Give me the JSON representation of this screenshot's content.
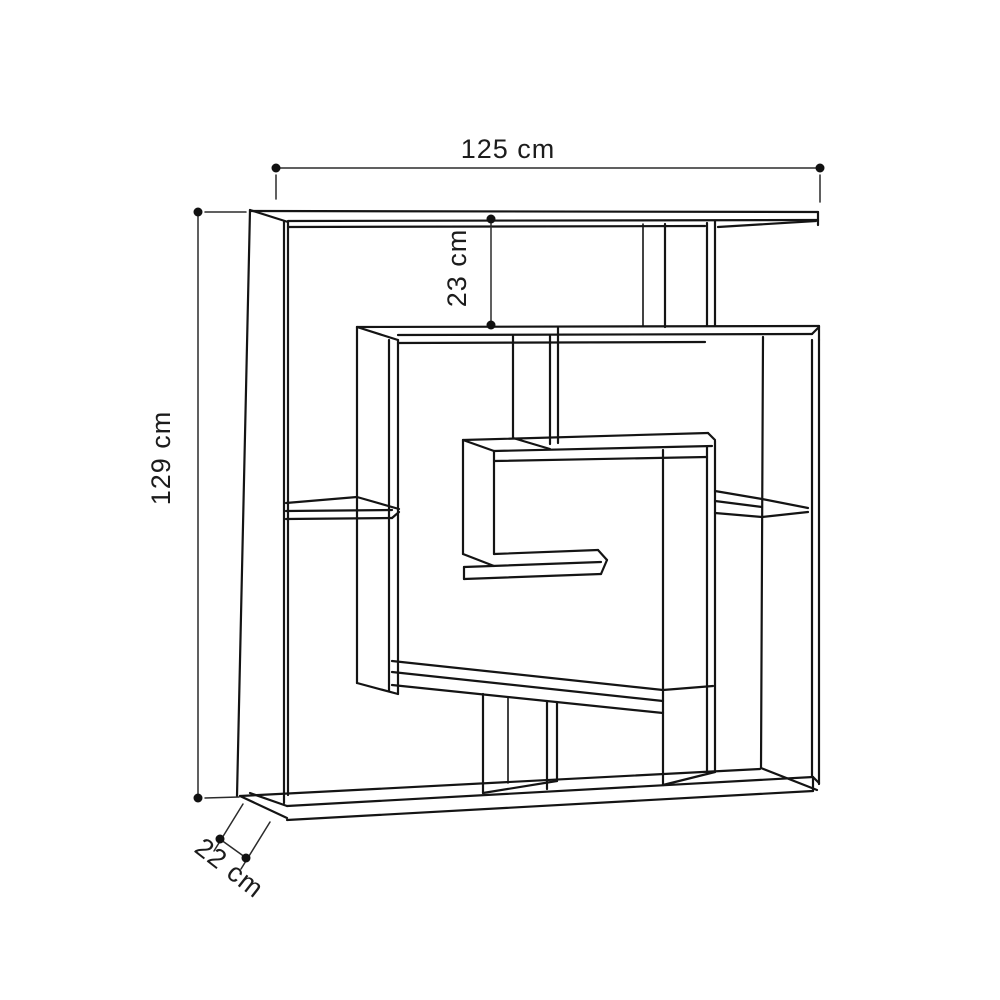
{
  "diagram": {
    "kind": "furniture-dimension-line-drawing",
    "labels": {
      "width": "125 cm",
      "height": "129 cm",
      "top_section": "23 cm",
      "depth": "22 cm"
    },
    "colors": {
      "background": "#ffffff",
      "line": "#141414",
      "dimension": "#2b2b2b",
      "text": "#1c1c1c"
    }
  }
}
